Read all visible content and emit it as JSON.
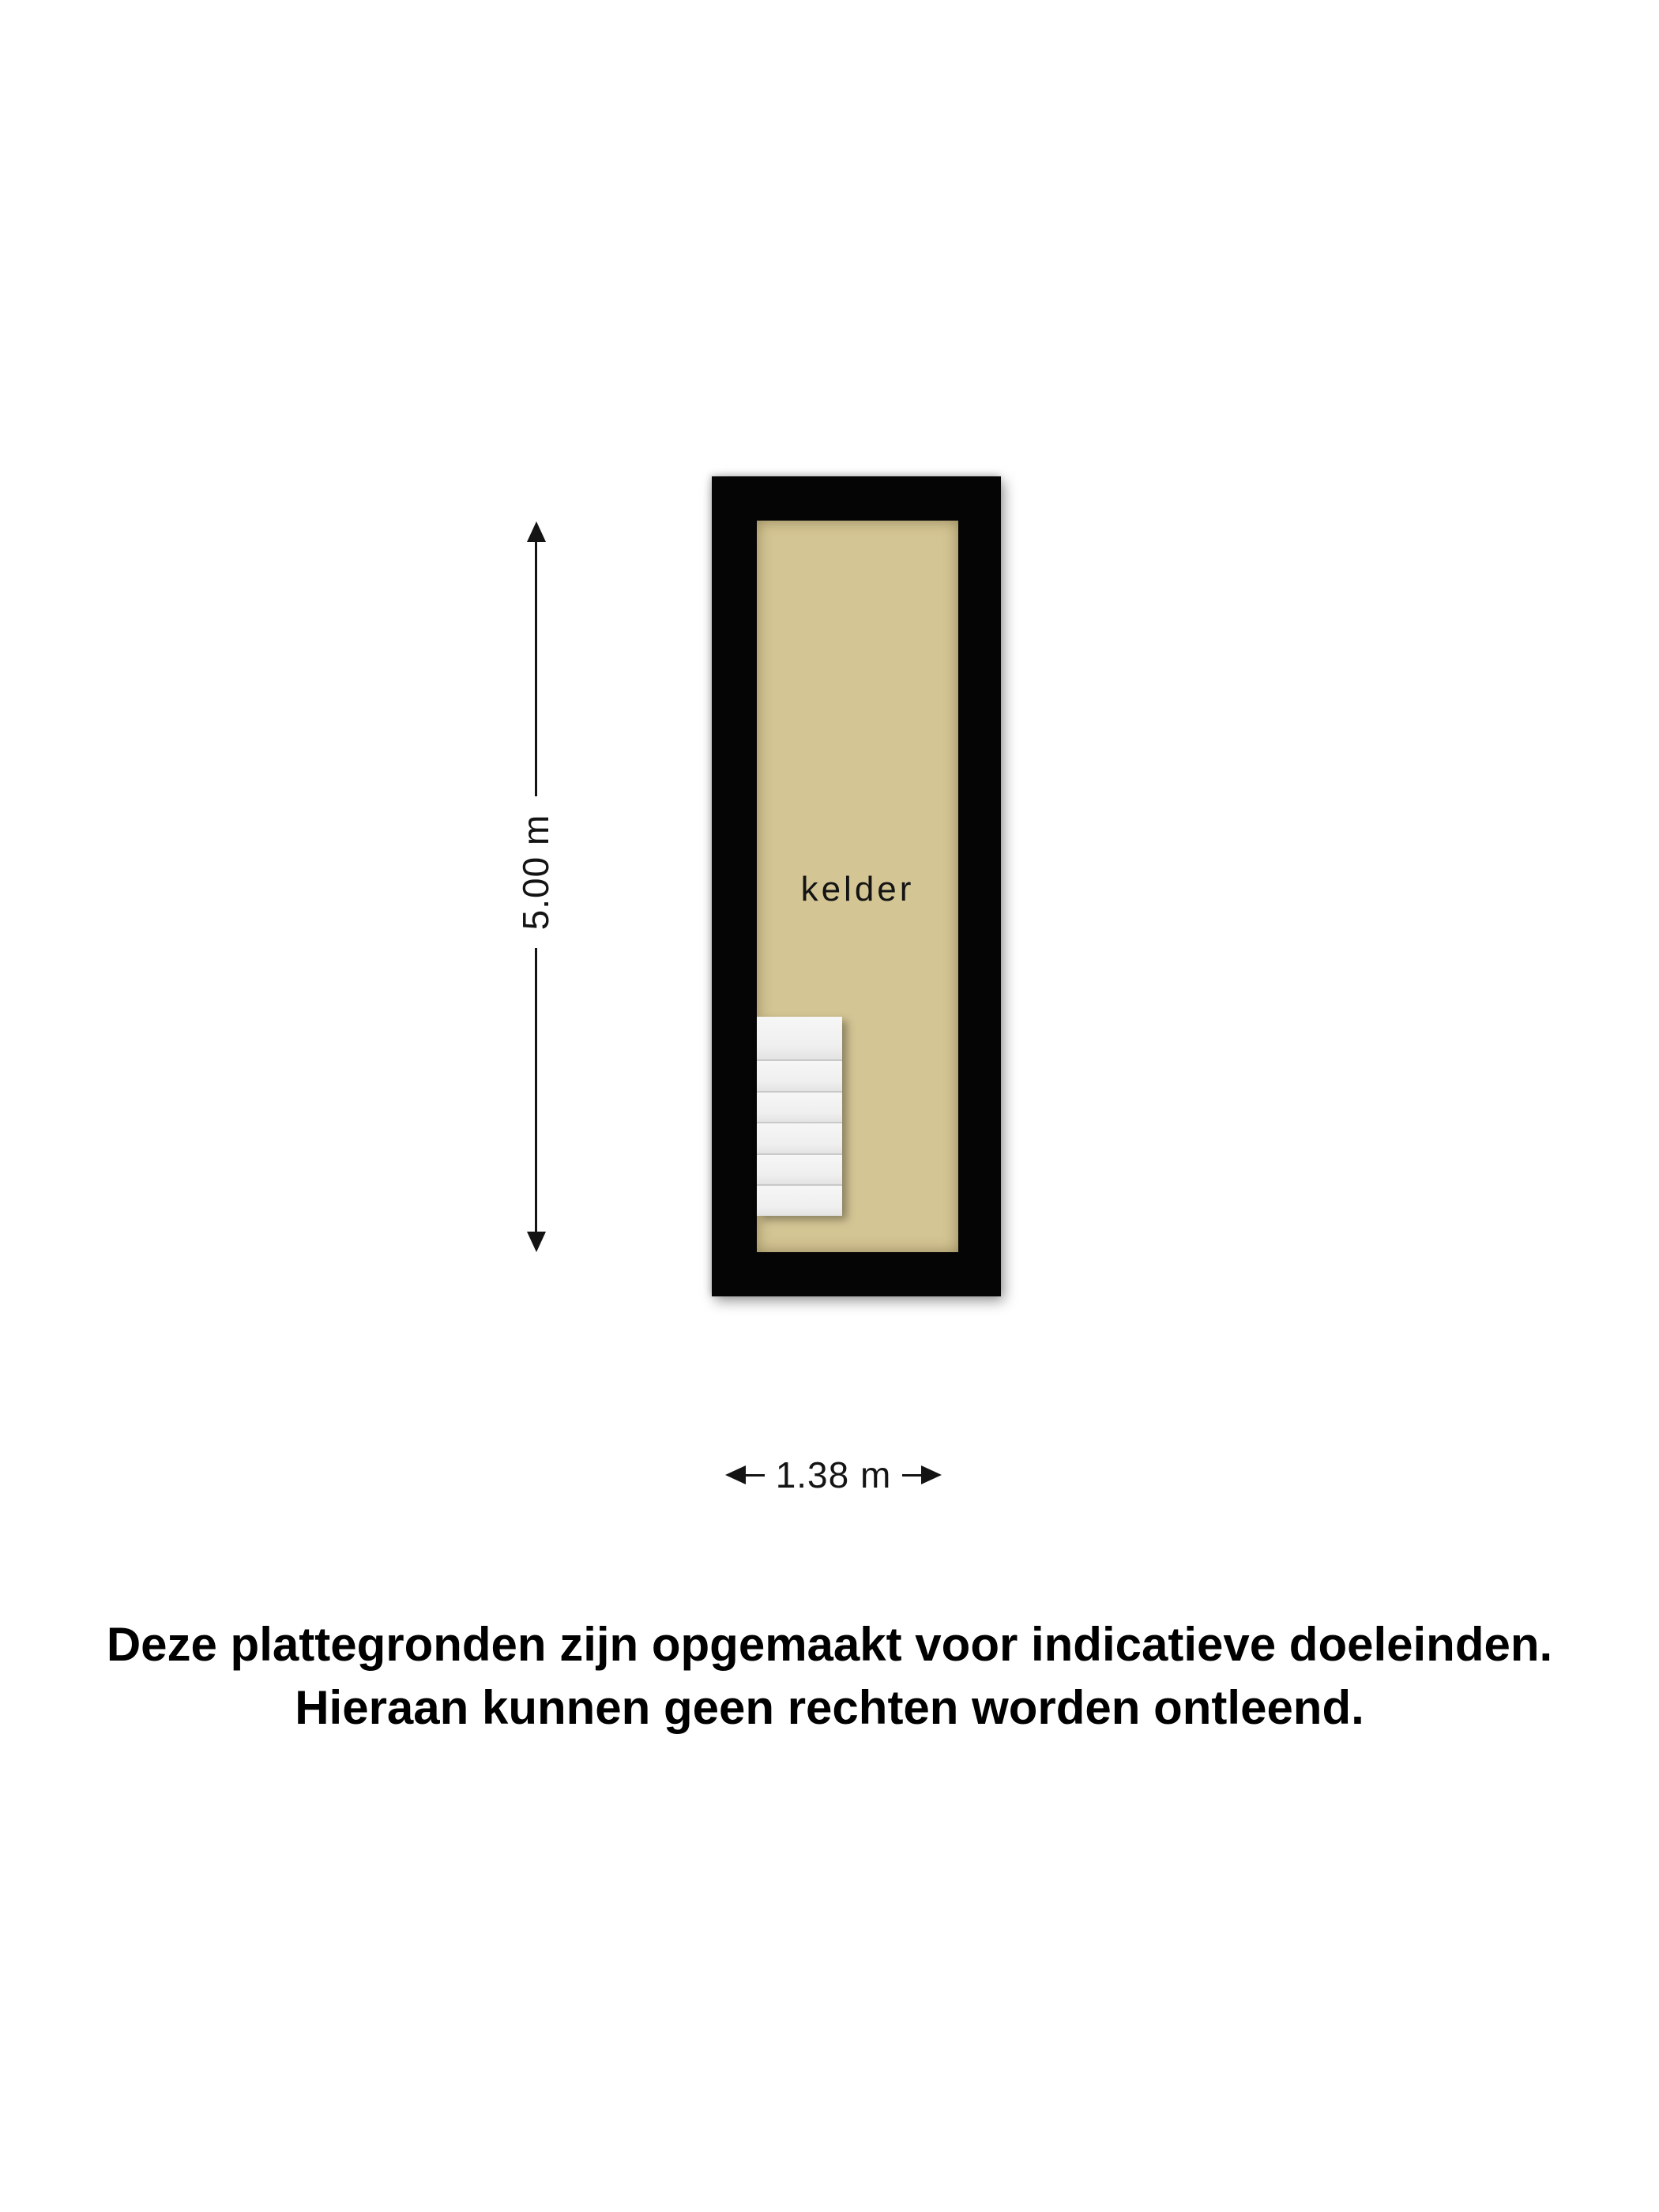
{
  "floorplan": {
    "room": {
      "label": "kelder"
    },
    "dimensions": {
      "height_label": "5.00 m",
      "width_label": "1.38 m"
    },
    "stairs": {
      "steps": 6
    },
    "colors": {
      "wall": "#050505",
      "floor": "#d4c594",
      "dimension_ink": "#141414"
    }
  },
  "disclaimer": {
    "line1": "Deze plattegronden zijn opgemaakt voor indicatieve doeleinden.",
    "line2": "Hieraan kunnen geen rechten worden ontleend."
  }
}
